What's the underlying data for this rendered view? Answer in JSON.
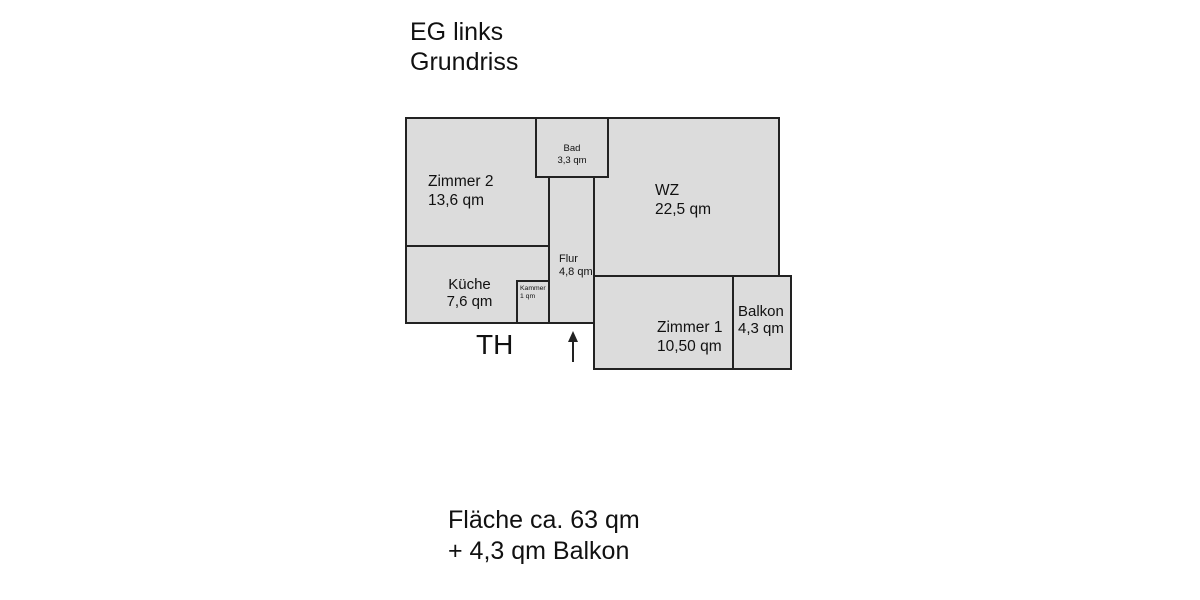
{
  "title": {
    "line1": "EG links",
    "line2": "Grundriss"
  },
  "rooms": [
    {
      "name": "Zimmer 2",
      "area": "13,6 qm"
    },
    {
      "name": "Küche",
      "area": "7,6 qm"
    },
    {
      "name": "Bad",
      "area": "3,3 qm"
    },
    {
      "name": "Flur",
      "area": "4,8 qm"
    },
    {
      "name": "Kammer",
      "area": "1 qm"
    },
    {
      "name": "WZ",
      "area": "22,5 qm"
    },
    {
      "name": "Zimmer 1",
      "area": "10,50 qm"
    },
    {
      "name": "Balkon",
      "area": "4,3 qm"
    }
  ],
  "annotations": {
    "stairwell": "TH"
  },
  "footer": {
    "line1": "Fläche ca. 63 qm",
    "line2": "+ 4,3 qm Balkon"
  },
  "colors": {
    "room_fill": "#dcdcdc",
    "wall": "#222222",
    "text": "#111111"
  }
}
